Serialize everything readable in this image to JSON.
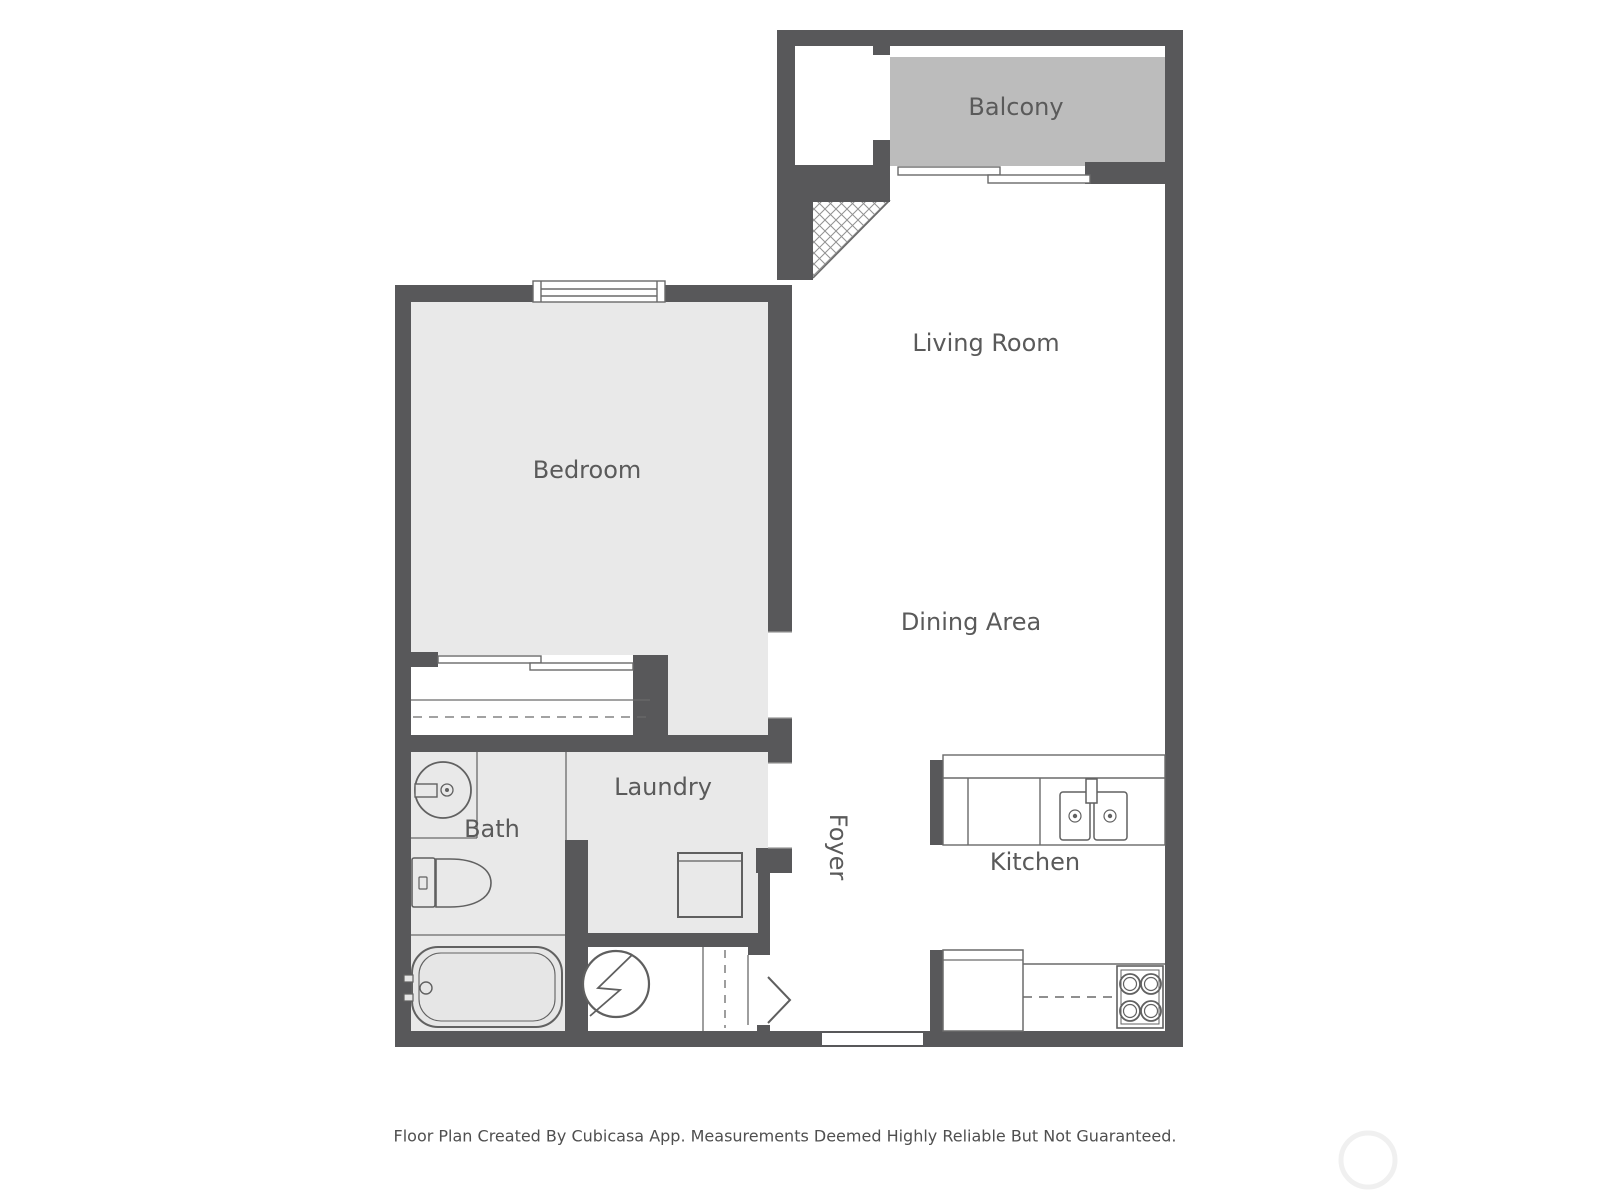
{
  "rooms": {
    "balcony": {
      "label": "Balcony"
    },
    "living_room": {
      "label": "Living Room"
    },
    "bedroom": {
      "label": "Bedroom"
    },
    "dining_area": {
      "label": "Dining Area"
    },
    "laundry": {
      "label": "Laundry"
    },
    "bath": {
      "label": "Bath"
    },
    "foyer": {
      "label": "Foyer",
      "rotation_deg": 90
    },
    "kitchen": {
      "label": "Kitchen"
    }
  },
  "fixtures": [
    "bedroom-window",
    "closet-sliding-door",
    "balcony-sliding-door",
    "bathroom-sink",
    "toilet",
    "bathtub",
    "washer",
    "water-heater",
    "kitchen-double-sink",
    "refrigerator",
    "stove-4-burner",
    "entry-door-swing",
    "foyer-closet",
    "hatched-area",
    "watermark-circle"
  ],
  "footer": {
    "disclaimer": "Floor Plan Created By Cubicasa App. Measurements Deemed Highly Reliable But Not Guaranteed."
  },
  "colors": {
    "wall": "#58585a",
    "balcony_fill": "#bcbcbc",
    "room_fill": "#e9e9e9",
    "fixture_line": "#616161",
    "label_text": "#5a5a5a",
    "footer_text": "#4f4f4f",
    "watermark": "#f0f0f0"
  }
}
